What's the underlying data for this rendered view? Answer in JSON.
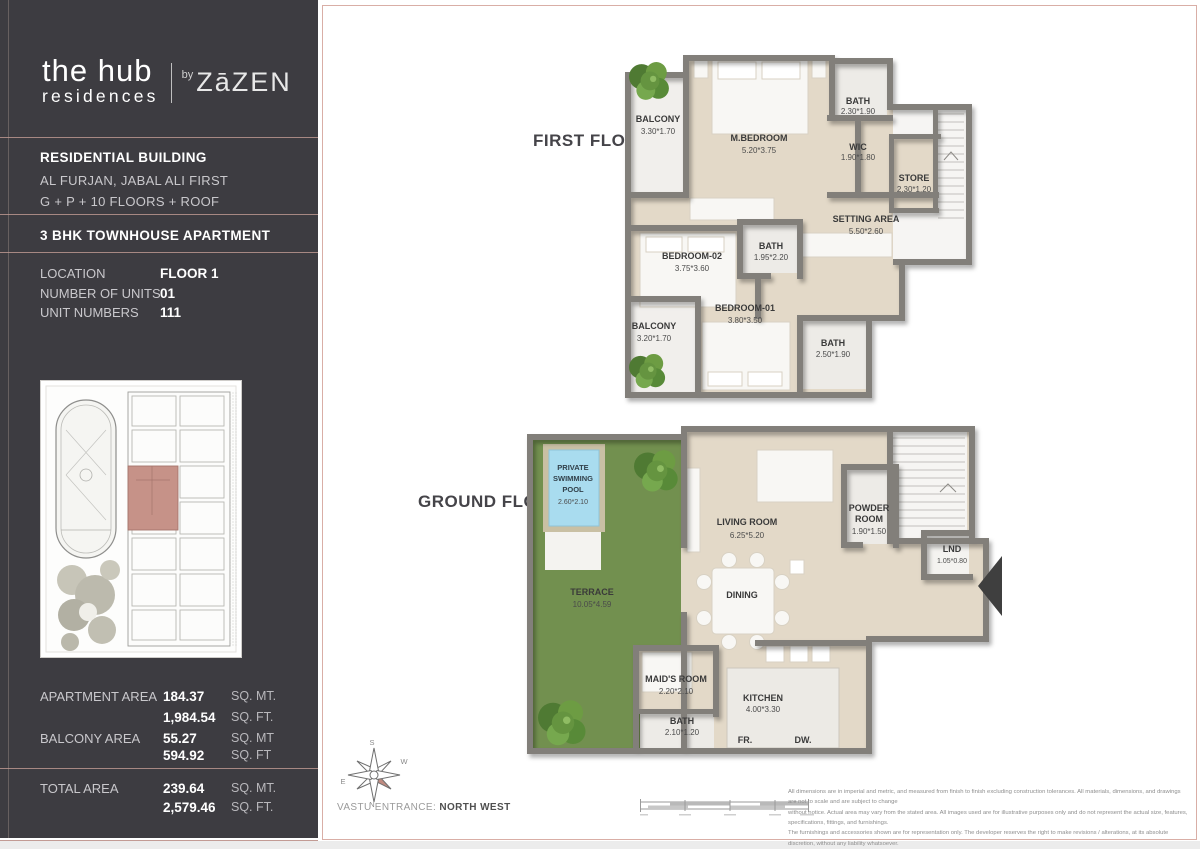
{
  "sidebar": {
    "brand": {
      "name_top": "the hub",
      "name_bottom": "residences",
      "by": "by",
      "developer": "ZāZEN"
    },
    "building": {
      "title": "RESIDENTIAL BUILDING",
      "line2": "AL FURJAN, JABAL ALI FIRST",
      "line3": "G + P + 10 FLOORS + ROOF"
    },
    "unit_type": "3 BHK TOWNHOUSE APARTMENT",
    "details": [
      {
        "label": "LOCATION",
        "value": "FLOOR 1"
      },
      {
        "label": "NUMBER OF UNITS",
        "value": "01"
      },
      {
        "label": "UNIT NUMBERS",
        "value": "111"
      }
    ],
    "areas": [
      {
        "label": "APARTMENT AREA",
        "value1": "184.37",
        "unit1": "SQ. MT.",
        "value2": "1,984.54",
        "unit2": "SQ. FT."
      },
      {
        "label": "BALCONY AREA",
        "value1": "55.27",
        "unit1": "SQ. MT",
        "value2": "594.92",
        "unit2": "SQ. FT"
      }
    ],
    "total": {
      "label": "TOTAL AREA",
      "value1": "239.64",
      "unit1": "SQ. MT.",
      "value2": "2,579.46",
      "unit2": "SQ. FT."
    }
  },
  "first_floor": {
    "title": "FIRST FLOOR",
    "rooms": {
      "balcony_top": {
        "name": "BALCONY",
        "dims": "3.30*1.70"
      },
      "master_bedroom": {
        "name": "M.BEDROOM",
        "dims": "5.20*3.75"
      },
      "bath_top": {
        "name": "BATH",
        "dims": "2.30*1.90"
      },
      "wic": {
        "name": "WIC",
        "dims": "1.90*1.80"
      },
      "store": {
        "name": "STORE",
        "dims": "2.30*1.20"
      },
      "setting_area": {
        "name": "SETTING AREA",
        "dims": "5.50*2.60"
      },
      "bedroom_02": {
        "name": "BEDROOM-02",
        "dims": "3.75*3.60"
      },
      "bath_mid": {
        "name": "BATH",
        "dims": "1.95*2.20"
      },
      "bedroom_01": {
        "name": "BEDROOM-01",
        "dims": "3.80*3.50"
      },
      "balcony_bottom": {
        "name": "BALCONY",
        "dims": "3.20*1.70"
      },
      "bath_bottom": {
        "name": "BATH",
        "dims": "2.50*1.90"
      }
    }
  },
  "ground_floor": {
    "title": "GROUND FLOOR",
    "rooms": {
      "pool": {
        "line1": "PRIVATE",
        "line2": "SWIMMING",
        "line3": "POOL",
        "dims": "2.60*2.10"
      },
      "terrace": {
        "name": "TERRACE",
        "dims": "10.05*4.59"
      },
      "living_room": {
        "name": "LIVING ROOM",
        "dims": "6.25*5.20"
      },
      "dining": {
        "name": "DINING"
      },
      "powder_room": {
        "line1": "POWDER",
        "line2": "ROOM",
        "dims": "1.90*1.50"
      },
      "lnd": {
        "name": "LND",
        "dims": "1.05*0.80"
      },
      "maids_room": {
        "name": "MAID'S ROOM",
        "dims": "2.20*2.10"
      },
      "bath": {
        "name": "BATH",
        "dims": "2.10*1.20"
      },
      "kitchen": {
        "name": "KITCHEN",
        "dims": "4.00*3.30"
      },
      "fr": {
        "name": "FR."
      },
      "dw": {
        "name": "DW."
      }
    }
  },
  "footer": {
    "vastu_label": "VASTU ENTRANCE:",
    "vastu_value": "NORTH WEST",
    "compass": {
      "top": "S",
      "right": "W",
      "left": "E",
      "bottom": "N"
    },
    "disclaimer_lines": [
      "All dimensions are in imperial and metric, and measured from finish to finish excluding construction tolerances. All materials, dimensions, and drawings are not to scale and are subject to change",
      "without notice. Actual area may vary from the stated area. All images used are for illustrative purposes only and do not represent the actual size, features, specifications, fittings, and furnishings.",
      "The furnishings and accessories shown are for representation only. The developer reserves the right to make revisions / alterations, at its absolute discretion, without any liability whatsoever."
    ]
  },
  "colors": {
    "sidebar_bg": "#3d3c41",
    "accent_rose": "#c29b94",
    "wall_gray": "#827f7a",
    "floor_beige": "#e3d9c8",
    "terrace_green": "#72904f",
    "pool_blue": "#a9dcef",
    "unit_highlight": "#c69288"
  }
}
